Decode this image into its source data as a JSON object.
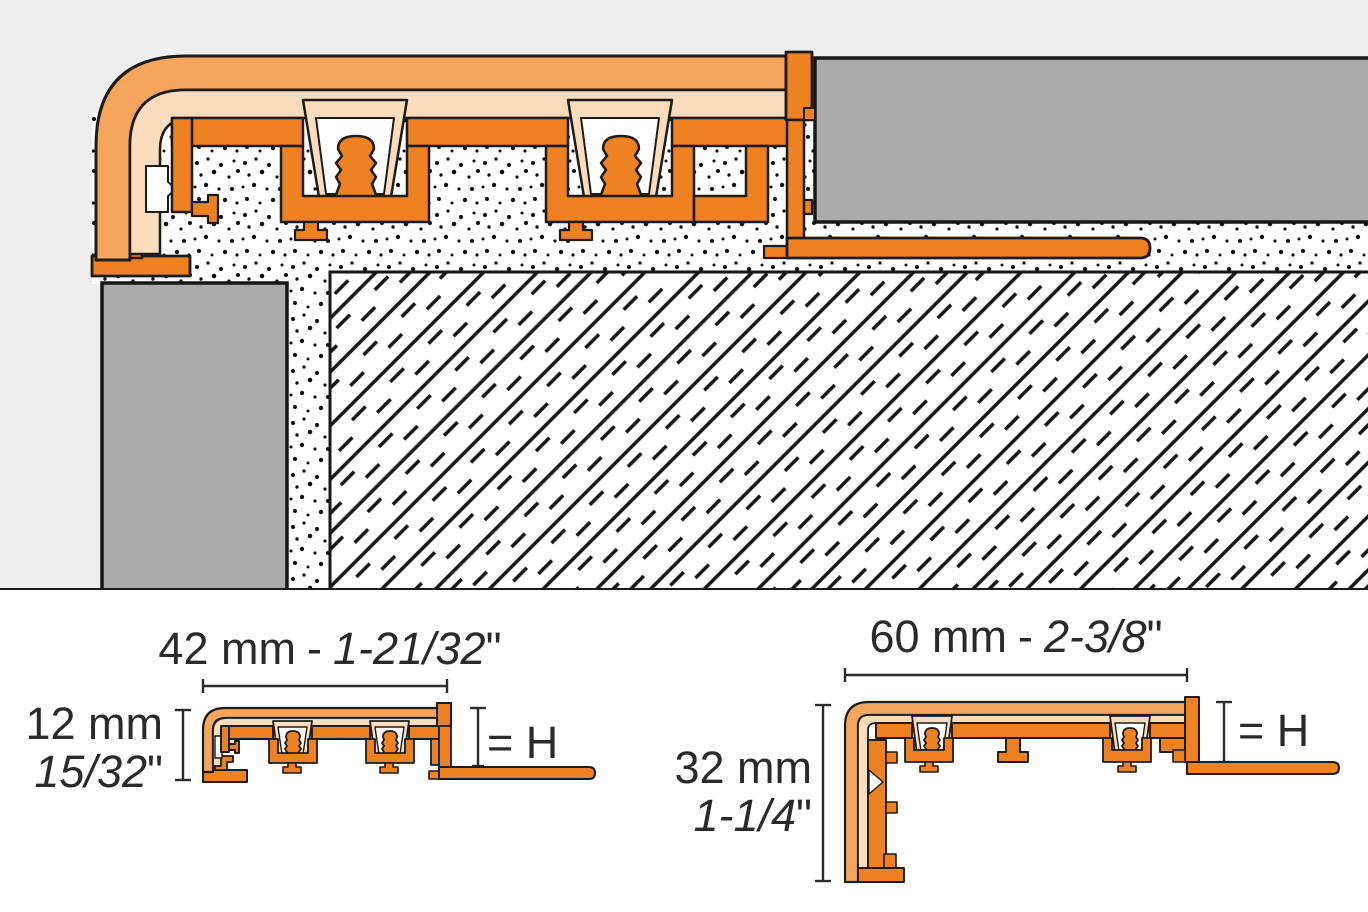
{
  "drawing": {
    "title": "Stair nosing edge profile installation cross-section with mortar bed, screed and tile coverings",
    "views": [
      "installation-cross-section",
      "small-profile-dimension-view",
      "large-profile-dimension-view"
    ]
  },
  "colors": {
    "profile_orange": "#EE8122",
    "band_orange": "#F5A65C",
    "insert_peach": "#FBDCBD",
    "tile_gray": "#ABABAB",
    "background_gray": "#EFEFEF",
    "line_black": "#1C1C1C"
  },
  "profiles": {
    "small": {
      "width_metric": "42 mm",
      "separator": "-",
      "width_imperial": "1-21/32",
      "unit_mark": "\"",
      "height_metric": "12 mm",
      "height_imperial": "15/32",
      "height_note": "= H"
    },
    "large": {
      "width_metric": "60 mm",
      "separator": "-",
      "width_imperial": "2-3/8",
      "unit_mark": "\"",
      "height_metric": "32 mm",
      "height_imperial": "1-1/4",
      "height_note": "= H"
    }
  }
}
